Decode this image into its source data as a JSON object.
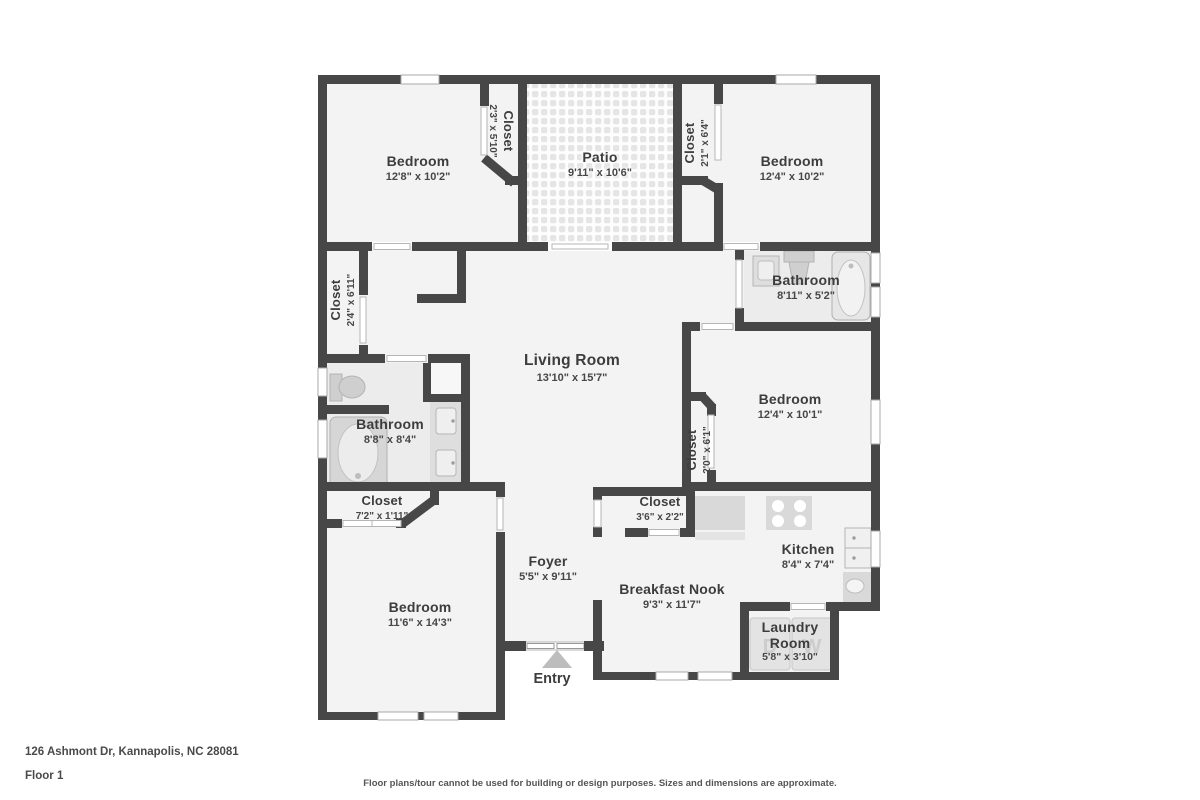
{
  "meta": {
    "address": "126 Ashmont Dr, Kannapolis, NC 28081",
    "floor": "Floor 1",
    "disclaimer": "Floor plans/tour cannot be used for building or design purposes. Sizes and dimensions are approximate."
  },
  "rooms": [
    {
      "id": "bedroom-top-left",
      "name": "Bedroom",
      "dims": "12'8\" x 10'2\""
    },
    {
      "id": "closet-top-left",
      "name": "Closet",
      "dims": "2'3\" x 5'10\""
    },
    {
      "id": "patio",
      "name": "Patio",
      "dims": "9'11\" x 10'6\""
    },
    {
      "id": "closet-top-right",
      "name": "Closet",
      "dims": "2'1\" x 6'4\""
    },
    {
      "id": "bedroom-top-right",
      "name": "Bedroom",
      "dims": "12'4\" x 10'2\""
    },
    {
      "id": "bathroom-right",
      "name": "Bathroom",
      "dims": "8'11\" x 5'2\""
    },
    {
      "id": "closet-hall-left",
      "name": "Closet",
      "dims": "2'4\" x 6'11\""
    },
    {
      "id": "living-room",
      "name": "Living Room",
      "dims": "13'10\" x 15'7\""
    },
    {
      "id": "bedroom-middle-right",
      "name": "Bedroom",
      "dims": "12'4\" x 10'1\""
    },
    {
      "id": "closet-bedroom-right",
      "name": "Closet",
      "dims": "2'0\" x 6'1\""
    },
    {
      "id": "bathroom-left",
      "name": "Bathroom",
      "dims": "8'8\" x 8'4\""
    },
    {
      "id": "closet-hallway",
      "name": "Closet",
      "dims": "7'2\" x 1'11\""
    },
    {
      "id": "closet-foyer",
      "name": "Closet",
      "dims": "3'6\" x 2'2\""
    },
    {
      "id": "kitchen",
      "name": "Kitchen",
      "dims": "8'4\" x 7'4\""
    },
    {
      "id": "foyer",
      "name": "Foyer",
      "dims": "5'5\" x 9'11\""
    },
    {
      "id": "breakfast-nook",
      "name": "Breakfast Nook",
      "dims": "9'3\" x 11'7\""
    },
    {
      "id": "bedroom-bottom-left",
      "name": "Bedroom",
      "dims": "11'6\" x 14'3\""
    },
    {
      "id": "laundry",
      "name": "Laundry Room",
      "dims": "5'8\" x 3'10\""
    }
  ],
  "labels": {
    "entry": "Entry"
  },
  "fixtures": {
    "dryer_letter": "D",
    "washer_letter": "W"
  },
  "colors": {
    "wall": "#474747",
    "room_fill": "#f3f3f3",
    "bath_fill": "#ececec",
    "fixture": "#d9d9d9",
    "accent_text": "#3d3d3d"
  }
}
